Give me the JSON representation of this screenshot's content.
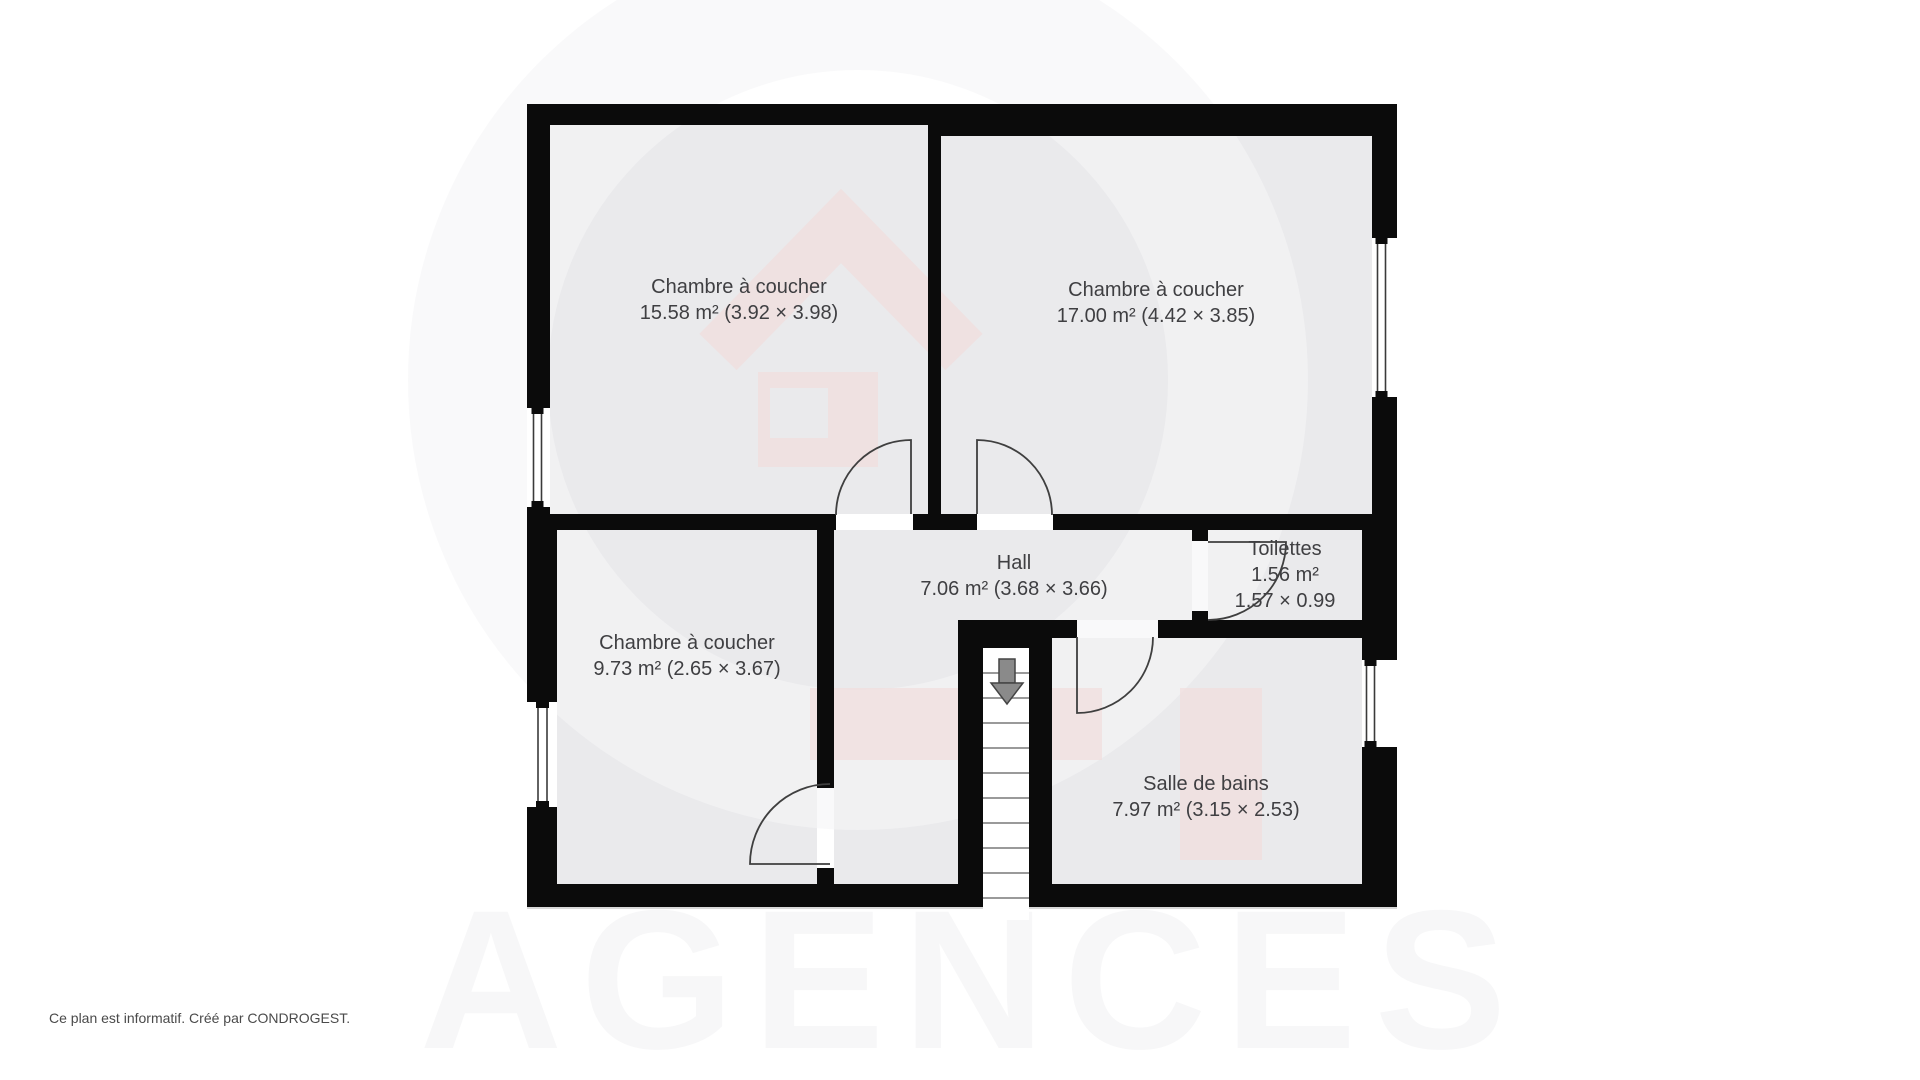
{
  "footer": {
    "text": "Ce plan est informatif. Créé par CONDROGEST."
  },
  "watermark": {
    "text": "AGENCES",
    "text_color": "#f7f7f8",
    "ring_color": "#f5f5f7",
    "pink_color": "#f0dede"
  },
  "plan": {
    "colors": {
      "wall": "#0b0b0b",
      "room_fill": "#eaeaec",
      "door_stroke": "#3f3f3f",
      "window_line": "#3a3a3a",
      "tread_line": "#9a9a9a",
      "arrow_fill": "#8a8a8a",
      "arrow_stroke": "#444444",
      "shadow_line": "#cfcfcf"
    },
    "rooms": [
      {
        "id": "bedroom-top-left",
        "fill": [
          550,
          125,
          378,
          389
        ],
        "cx": 739,
        "cy": 300,
        "lines": [
          "Chambre à coucher",
          "15.58 m² (3.92 × 3.98)"
        ]
      },
      {
        "id": "bedroom-top-right",
        "fill": [
          941,
          136,
          431,
          378
        ],
        "cx": 1156,
        "cy": 303,
        "lines": [
          "Chambre à coucher",
          "17.00 m² (4.42 × 3.85)"
        ]
      },
      {
        "id": "bedroom-bottom-left",
        "fill": [
          557,
          530,
          260,
          354
        ],
        "cx": 687,
        "cy": 656,
        "lines": [
          "Chambre à coucher",
          "9.73 m² (2.65 × 3.67)"
        ]
      },
      {
        "id": "hall",
        "fill": [
          834,
          530,
          358,
          90
        ],
        "cx": 1014,
        "cy": 576,
        "lines": [
          "Hall",
          "7.06 m² (3.68 × 3.66)"
        ]
      },
      {
        "id": "toilettes",
        "fill": [
          1208,
          530,
          154,
          90
        ],
        "cx": 1285,
        "cy": 575,
        "lines": [
          "Toilettes",
          "1.56 m²",
          "1.57 × 0.99"
        ]
      },
      {
        "id": "salle-de-bains",
        "fill": [
          1052,
          638,
          310,
          246
        ],
        "cx": 1206,
        "cy": 797,
        "lines": [
          "Salle de bains",
          "7.97 m² (3.15 × 2.53)"
        ]
      }
    ],
    "extra_fills": [
      [
        834,
        530,
        124,
        354
      ]
    ],
    "walls": [
      [
        527,
        104,
        414,
        21
      ],
      [
        941,
        104,
        456,
        32
      ],
      [
        527,
        104,
        23,
        412
      ],
      [
        527,
        516,
        30,
        391
      ],
      [
        1372,
        104,
        25,
        412
      ],
      [
        1362,
        516,
        35,
        391
      ],
      [
        527,
        884,
        870,
        23
      ],
      [
        928,
        104,
        13,
        422
      ],
      [
        527,
        514,
        309,
        16
      ],
      [
        913,
        514,
        64,
        16
      ],
      [
        1053,
        514,
        344,
        16
      ],
      [
        817,
        530,
        17,
        258
      ],
      [
        817,
        868,
        17,
        16
      ],
      [
        1192,
        530,
        16,
        11
      ],
      [
        1192,
        611,
        16,
        10
      ],
      [
        1052,
        620,
        25,
        18
      ],
      [
        1158,
        620,
        239,
        18
      ],
      [
        958,
        620,
        94,
        28
      ],
      [
        958,
        620,
        25,
        287
      ],
      [
        1029,
        648,
        23,
        236
      ]
    ],
    "shadow": [
      527,
      907,
      870,
      2
    ],
    "windows": [
      {
        "rect": [
          527,
          408,
          23,
          99
        ],
        "l1": 533.5,
        "l2": 541.5
      },
      {
        "rect": [
          527,
          702,
          30,
          105
        ],
        "l1": 538,
        "l2": 547
      },
      {
        "rect": [
          1372,
          238,
          25,
          159
        ],
        "l1": 1377.5,
        "l2": 1385.5
      },
      {
        "rect": [
          1362,
          660,
          35,
          87
        ],
        "l1": 1366.5,
        "l2": 1374.5
      }
    ],
    "doors": [
      {
        "id": "door-bedroom-top-left",
        "path": "M911 514 L911 440 A75 75 0 0 0 836 515"
      },
      {
        "id": "door-bedroom-top-right",
        "path": "M977 514 L977 440 A75 75 0 0 1 1052 515"
      },
      {
        "id": "door-bedroom-bottom-left",
        "path": "M830 864 L750 864 A80 80 0 0 1 830 784"
      },
      {
        "id": "door-toilettes",
        "path": "M1208 542 L1286 542 A78 78 0 0 1 1208 620"
      },
      {
        "id": "door-salle-de-bains",
        "path": "M1077 637 L1077 713 A76 76 0 0 0 1153 637"
      }
    ],
    "stairs": {
      "strip": [
        983,
        648,
        46,
        272
      ],
      "tread_x1": 983,
      "tread_x2": 1029,
      "tread_y0": 673,
      "tread_dy": 25,
      "tread_n": 10,
      "arrow_stem": [
        999,
        659,
        16,
        24
      ],
      "arrow_head": "991,683 1023,683 1007,704"
    },
    "logo": {
      "ring": {
        "cx": 858,
        "cy": 380,
        "r": 380,
        "stroke_width": 140,
        "opacity": 0.6
      },
      "roof_path": "M718 352 L841 226 L964 352",
      "roof_stroke_width": 52,
      "pink_opacity": 0.75,
      "pink_rects": [
        [
          758,
          372,
          120,
          95
        ],
        [
          810,
          688,
          292,
          72
        ],
        [
          1180,
          688,
          82,
          172
        ]
      ],
      "hole_rect": [
        770,
        388,
        58,
        50
      ]
    },
    "agences_pos": {
      "x": 972,
      "y": 1048,
      "font_size": 198,
      "letter_spacing": 18
    }
  }
}
